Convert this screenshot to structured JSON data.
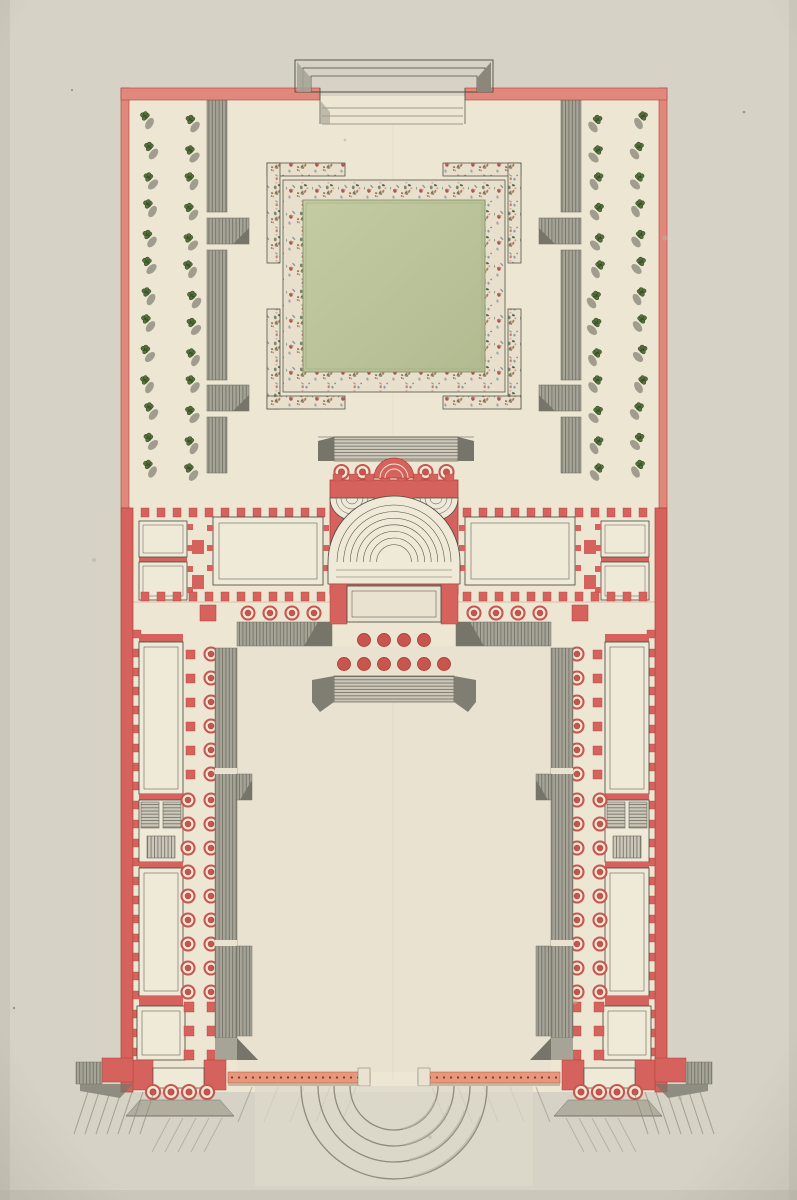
{
  "document": {
    "type": "architectural ground plan",
    "medium": "pen, ink and watercolor on laid paper",
    "subject": "Plan of a palace: entrance forecourt with semicircular steps, U-shaped corps de logis and wings, rear parterre garden with tree allees",
    "text_labels": []
  },
  "palette": {
    "paper": "#d6d2c5",
    "paper_edge": "#c3bfb2",
    "garden_bg": "#ede6d3",
    "court_bg": "#e9e2d0",
    "wall_pink": "#e1887d",
    "wall_red": "#d5625c",
    "red_dark": "#b04138",
    "dot_red": "#c8554e",
    "orange_band": "#e6987d",
    "orange_dot": "#8f2f26",
    "gray": "#a6a397",
    "gray_mid": "#b1ae9f",
    "gray_dark": "#77746a",
    "hatch": "#6e6b60",
    "ink": "#4c4b42",
    "room_fill": "#efe9d8",
    "lawn1": "#c3cba3",
    "lawn2": "#b2bb90",
    "lawn_edge": "#7e8c60",
    "tree_green": "#55703e",
    "tree_dark": "#33491f",
    "tree_shadow": "#a19d8e",
    "parterre_bg": "#e8e0cc",
    "speckles": [
      "#a8453c",
      "#5f7f6b",
      "#3f5a40",
      "#c48f94",
      "#6e7e96",
      "#8f5d2e"
    ]
  },
  "garden": {
    "tree_columns_per_side": 2,
    "trees_per_column": 13,
    "tree_row_spacing": 29,
    "entrance_steps": 3,
    "portico_columns": 6,
    "parterre_corner_brackets": 4
  },
  "palace": {
    "grand_stair_rings": 7,
    "corner_stair_rings": 3,
    "apse_rings": 2,
    "vestibule_rows": [
      4,
      6
    ],
    "north_pilasters": 12
  },
  "wings": {
    "wall_pilasters": 24,
    "single_colonnade": 6,
    "double_colonnade_rows": 9,
    "rooms_per_wing": 4
  },
  "entry": {
    "pavilion_columns": 4,
    "arc_radii": [
      44,
      60,
      76,
      93
    ],
    "band_dot_spacing": 7
  }
}
